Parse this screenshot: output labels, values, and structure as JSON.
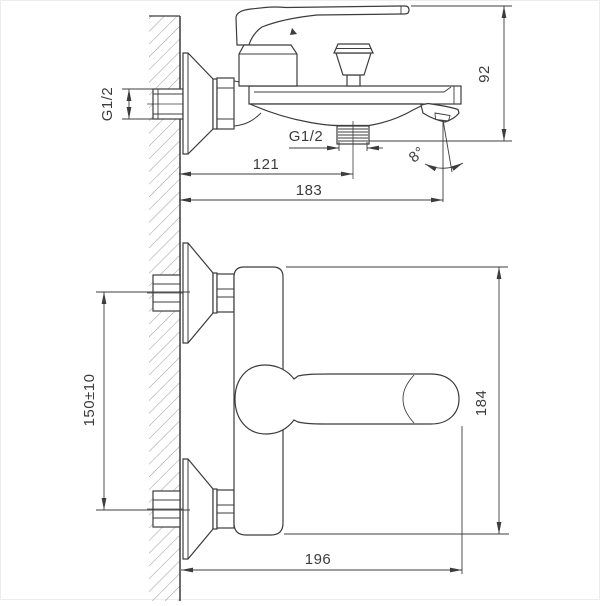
{
  "page": {
    "background": "#ffffff",
    "line_color": "#3c3c3c",
    "hatch_color": "#9a9a9a"
  },
  "drawing": {
    "kind": "technical dimension drawing",
    "subject": "wall-mounted bath mixer faucet, two projection views"
  },
  "views": {
    "side": {
      "name": "side view",
      "labels": {
        "inlet_thread": "G1/2",
        "outlet_thread": "G1/2",
        "height": "92",
        "wall_to_shower_outlet": "121",
        "wall_to_spout_tip": "183",
        "spout_angle": "8°"
      }
    },
    "front": {
      "name": "front view",
      "labels": {
        "inlet_spacing": "150±10",
        "overall_height": "184",
        "overall_depth": "196"
      }
    }
  }
}
